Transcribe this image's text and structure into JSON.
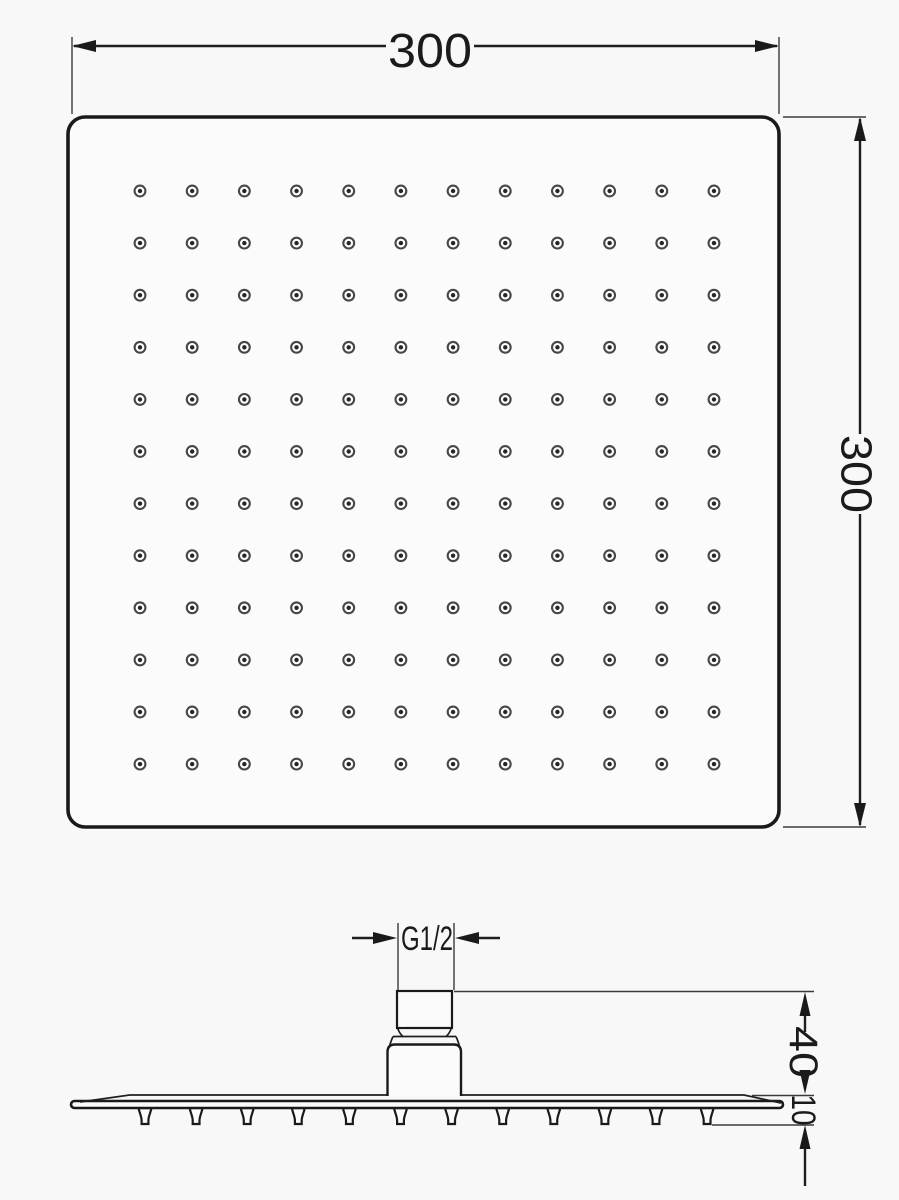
{
  "dimensions": {
    "top_width": "300",
    "right_height": "300",
    "thread": "G1/2",
    "connector_height": "40",
    "plate_thickness": "10"
  },
  "nozzle_grid": {
    "rows": 12,
    "cols": 12
  },
  "side_view": {
    "nozzle_count": 12
  },
  "colors": {
    "line": "#1a1a1a",
    "dot_ring": "#474747",
    "dot_center": "#262626",
    "background": "#f8f8f8"
  }
}
